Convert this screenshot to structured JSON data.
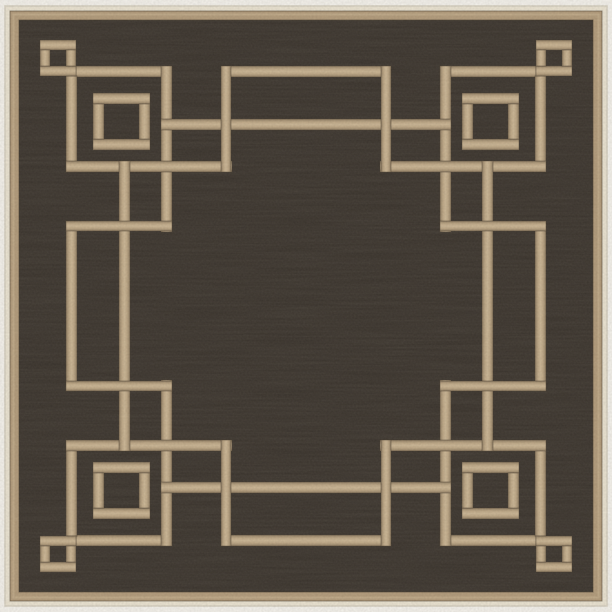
{
  "image": {
    "type": "product-photo",
    "subject": "Square indoor-outdoor area rug: black woven field with camel tan Greek key fret border, small and large squares in each corner, cream edge binding, on white background",
    "background_color": "#f5f3ee"
  },
  "rug": {
    "canvas": {
      "w": 612,
      "h": 612
    },
    "colors": {
      "background": "#f5f3ee",
      "binding_cream": "#ebe4d3",
      "binding_stroke": "#d6d0c1",
      "band_tan": "#b19a7a",
      "band_highlight": "#c8b492",
      "line_tan_center": "#cbb695",
      "line_tan_edge": "#8f7c61",
      "line_outline": "#453a2c",
      "field_dark": "#38322c",
      "fleck_light": "#c9b893",
      "fleck_dark": "#161310"
    },
    "frame": {
      "binding": {
        "x": 5,
        "y": 6,
        "w": 602,
        "h": 600
      },
      "band": {
        "x": 10,
        "y": 11,
        "w": 592,
        "h": 590
      },
      "band_highlight_ring": {
        "x": 13.5,
        "y": 14.5,
        "w": 585,
        "h": 583
      },
      "field": {
        "x": 19,
        "y": 20,
        "w": 574,
        "h": 572
      }
    },
    "pattern": {
      "line_weight": 11,
      "mirror_w": 612,
      "mirror_h": 612,
      "squares_quadrant": [
        {
          "name": "corner-small-square",
          "x": 40,
          "y": 40,
          "size": 36,
          "t": 10
        },
        {
          "name": "corner-large-square",
          "x": 93,
          "y": 93,
          "size": 57,
          "t": 11
        }
      ],
      "segments_quadrant": [
        {
          "name": "small-square-arm-horizontal",
          "x": 76,
          "y": 66,
          "w": 96,
          "h": 11
        },
        {
          "name": "small-square-arm-vertical",
          "x": 66,
          "y": 76,
          "w": 11,
          "h": 96
        },
        {
          "name": "corner-return-vertical",
          "x": 161,
          "y": 66,
          "w": 11,
          "h": 166
        },
        {
          "name": "corner-return-horizontal",
          "x": 66,
          "y": 161,
          "w": 166,
          "h": 11
        },
        {
          "name": "top-main-line",
          "x": 161,
          "y": 119,
          "w": 290,
          "h": 11
        },
        {
          "name": "left-main-line",
          "x": 119,
          "y": 161,
          "w": 11,
          "h": 290
        },
        {
          "name": "top-bar-outer-edge",
          "x": 221,
          "y": 66,
          "w": 170,
          "h": 11
        },
        {
          "name": "top-bar-end",
          "x": 221,
          "y": 66,
          "w": 10,
          "h": 106
        },
        {
          "name": "left-bar-outer-edge",
          "x": 66,
          "y": 221,
          "w": 11,
          "h": 170
        },
        {
          "name": "left-bar-end",
          "x": 66,
          "y": 221,
          "w": 106,
          "h": 10
        }
      ]
    }
  }
}
